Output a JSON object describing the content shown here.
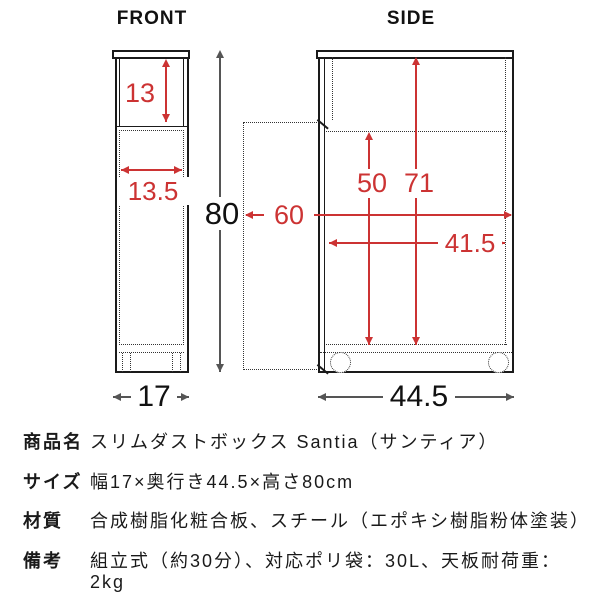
{
  "diagram": {
    "colors": {
      "dimension_red": "#cc3333",
      "outline_black": "#1a1a1a",
      "measure_gray": "#555555"
    },
    "front": {
      "title": "FRONT",
      "top_section_height": "13",
      "inner_width": "13.5",
      "overall_height": "80",
      "overall_width": "17"
    },
    "side": {
      "title": "SIDE",
      "lower_inner_height": "50",
      "full_inner_height": "71",
      "depth_door_open": "60",
      "inner_depth": "41.5",
      "overall_depth": "44.5"
    }
  },
  "specs": {
    "rows": [
      {
        "label": "商品名",
        "value": "スリムダストボックス Santia（サンティア）"
      },
      {
        "label": "サイズ",
        "value": "幅17×奥行き44.5×高さ80cm"
      },
      {
        "label": "材質",
        "value": "合成樹脂化粧合板、スチール（エポキシ樹脂粉体塗装）"
      },
      {
        "label": "備考",
        "value": "組立式（約30分）、対応ポリ袋：30L、天板耐荷重：2kg"
      }
    ]
  }
}
